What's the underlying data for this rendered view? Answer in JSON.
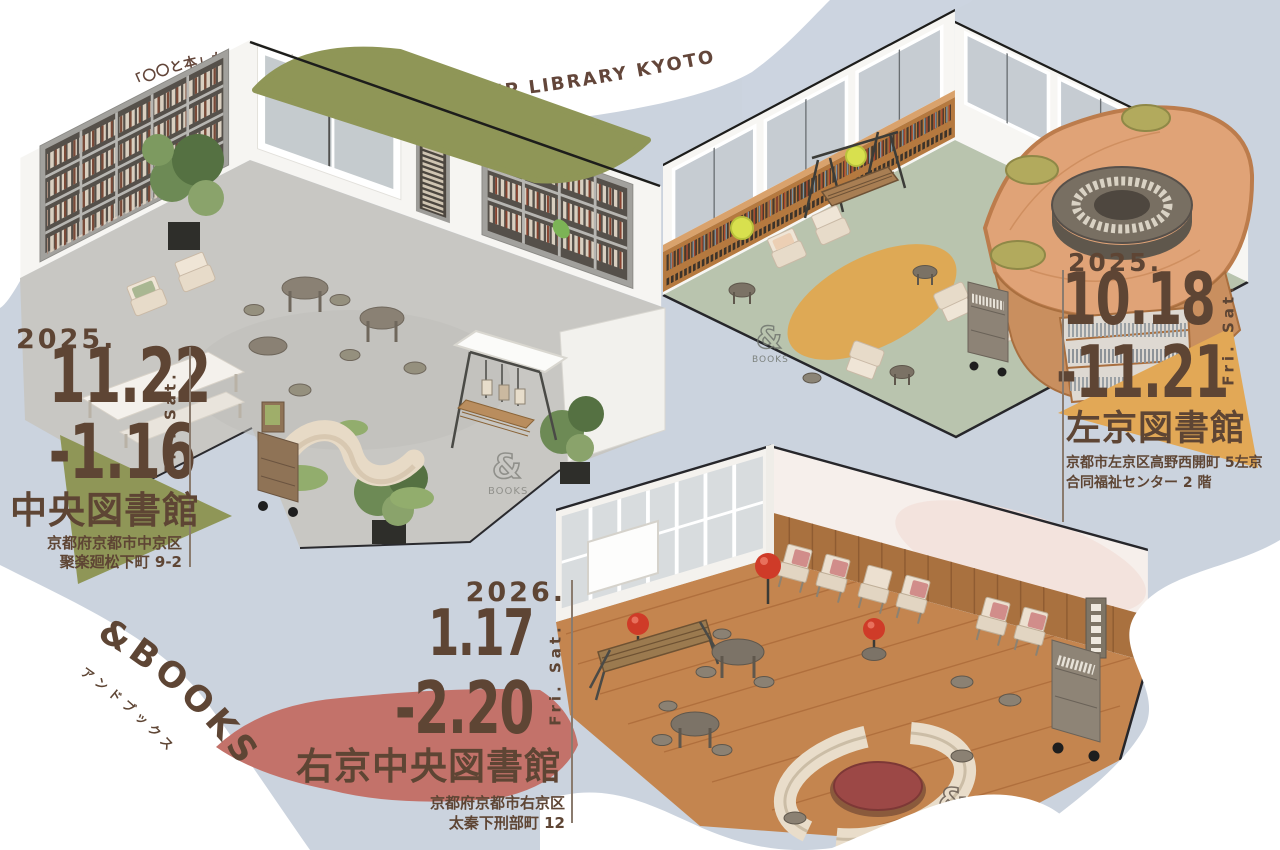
{
  "poster": {
    "tagline_jp": "「〇〇と本」からはじまる、新しい図書館の体験",
    "tagline_en": "POP-UP LIBRARY KYOTO",
    "brand": {
      "logo_en": "&BOOKS",
      "logo_jp": "アンドブックス",
      "sign_amp": "&",
      "sign_books": "BOOKS"
    },
    "events": [
      {
        "year": "2025.",
        "date_start": "11.22",
        "date_end": "-1.16",
        "days": "Fri. Sat.",
        "venue": "中央図書館",
        "address1": "京都府京都市中京区",
        "address2": "聚楽廻松下町 9-2"
      },
      {
        "year": "2025.",
        "date_start": "10.18",
        "date_end": "-11.21",
        "days": "Fri. Sat.",
        "venue": "左京図書館",
        "address1": "京都市左京区高野西開町 5左京",
        "address2": "合同福祉センター 2 階"
      },
      {
        "year": "2026.",
        "date_start": "1.17",
        "date_end": "-2.20",
        "days": "Fri. Sat.",
        "venue": "右京中央図書館",
        "address1": "京都府京都市右京区",
        "address2": "太秦下刑部町 12"
      }
    ],
    "colors": {
      "background": "#cbd3de",
      "paper_white": "#ffffff",
      "olive": "#8f9657",
      "mustard": "#e2a856",
      "rose": "#c3726a",
      "text_brown": "#5e4534"
    }
  }
}
